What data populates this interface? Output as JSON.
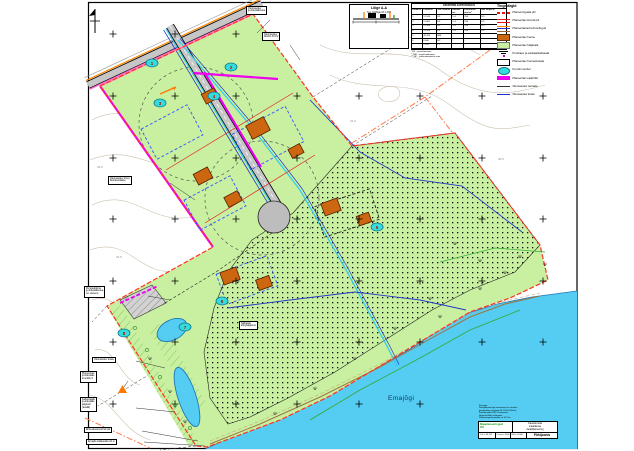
{
  "colors": {
    "parcel_green": "#c9f0a0",
    "water_blue": "#55ccf2",
    "building_brown": "#cc6611",
    "utility_magenta": "#ee00ee",
    "boundary_red": "#ff3322",
    "plot_bubble_cyan": "#33dddd",
    "road_gray": "#c6c6c6",
    "perspective_orange": "#ff7744"
  },
  "map": {
    "river_label": "Emajõgi",
    "contour_labels": [
      "31.5",
      "32.0",
      "31.0",
      "30.5"
    ],
    "plot_numbers": [
      "1",
      "2",
      "3",
      "4",
      "5",
      "6",
      "7",
      "8"
    ]
  },
  "scale_table": {
    "title": "KRUNTIDE EHITUSÕIGUS",
    "headers": [
      "Krundi nr",
      "Pindala m²",
      "Siht- otstarve",
      "Hoonete arv",
      "Ehitusalune pind m²",
      "Max kõrgus m"
    ],
    "rows": [
      [
        "1",
        "12 540",
        "EP",
        "1+1",
        "250",
        "8,5"
      ],
      [
        "2",
        "11 860",
        "EP",
        "1+1",
        "250",
        "8,5"
      ],
      [
        "3",
        "12 980",
        "EP",
        "1+1",
        "250",
        "8,5"
      ],
      [
        "4",
        "13 420",
        "EP",
        "1+1",
        "250",
        "8,5"
      ],
      [
        "5",
        "45 200",
        "MM",
        "–",
        "–",
        "–"
      ],
      [
        "6",
        "8 640",
        "HP",
        "–",
        "–",
        "–"
      ],
      [
        "7",
        "2 120",
        "LT",
        "–",
        "–",
        "–"
      ]
    ],
    "footnotes": [
      "* EP – pereelamumaa",
      "** MM – maatulundusmaa",
      "*** HP – puhkeotstarbeline maa"
    ]
  },
  "legend": {
    "title": "Tingmärgid",
    "items": [
      {
        "label": "Planeeringuala piir"
      },
      {
        "label": "Planeeritav krundi piir"
      },
      {
        "label": "Planeeritavad tehnovõrgud"
      },
      {
        "label": "Planeeritav hoone"
      },
      {
        "label": "Planeeritav haljasala"
      },
      {
        "label": "Puurkaev ja sanitaarkaitseala"
      },
      {
        "label": "Planeeritav hoonestusala"
      },
      {
        "label": "Krundi number"
      },
      {
        "label": "Planeeritav elektriliin"
      },
      {
        "label": "Olemasolev teerada"
      },
      {
        "label": "Olemasolev kraav"
      }
    ]
  },
  "section_box": {
    "title": "Lõige A-A",
    "caption": "Tee ristlõige M 1:100"
  },
  "callouts": {
    "top1": {
      "lines": [
        "Olemasolev",
        "juurdepääsutee"
      ]
    },
    "top2": {
      "lines": [
        "Olemasolev",
        "õhuliin 10 kV"
      ]
    },
    "mid_left": {
      "lines": [
        "Olemasolev truup",
        "likvideeritakse"
      ]
    },
    "left2": {
      "lines": [
        "Perspektiivne",
        "juurdepääsutee",
        "(vt. skeem)"
      ]
    },
    "b1": {
      "lines": [
        "Olemasolev kraav"
      ]
    },
    "b2": {
      "lines": [
        "Planeeritav",
        "juurdepääs",
        "krundile 6"
      ]
    },
    "b3": {
      "lines": [
        "Kallasrajale",
        "juurdepääs",
        "jalgteelt",
        "(avalik)"
      ]
    },
    "b4": {
      "lines": [
        "Ehituskeeluvööndi piir"
      ]
    },
    "b5": {
      "lines": [
        "Emajõe kallasrada 10 m"
      ]
    },
    "center": {
      "lines": [
        "Säilitatav",
        "kõrghaljastus"
      ]
    }
  },
  "title_block": {
    "notes": [
      "Koostaja:",
      "Detailplaneeringu koostamisel on aluseks",
      "geodeetiline alusplaan M 1:500 (2004.a).",
      "Koordinaadid L-EST süsteemis,",
      "kõrgused Balti süsteemis.",
      "Planeeringuala pindala ca 11,2 ha."
    ],
    "company_lines": [
      "Maaplaneeringud",
      "OÜ"
    ],
    "project_lines": [
      "Kavastu küla",
      "maaüksuse",
      "detailplaneering"
    ],
    "work_no_label": "Töö nr",
    "work_no": "04-112",
    "date_label": "Kuupäev",
    "date": "2005",
    "scale_label": "Mõõt",
    "scale": "1:1000",
    "drawing": "Põhijoonis"
  }
}
